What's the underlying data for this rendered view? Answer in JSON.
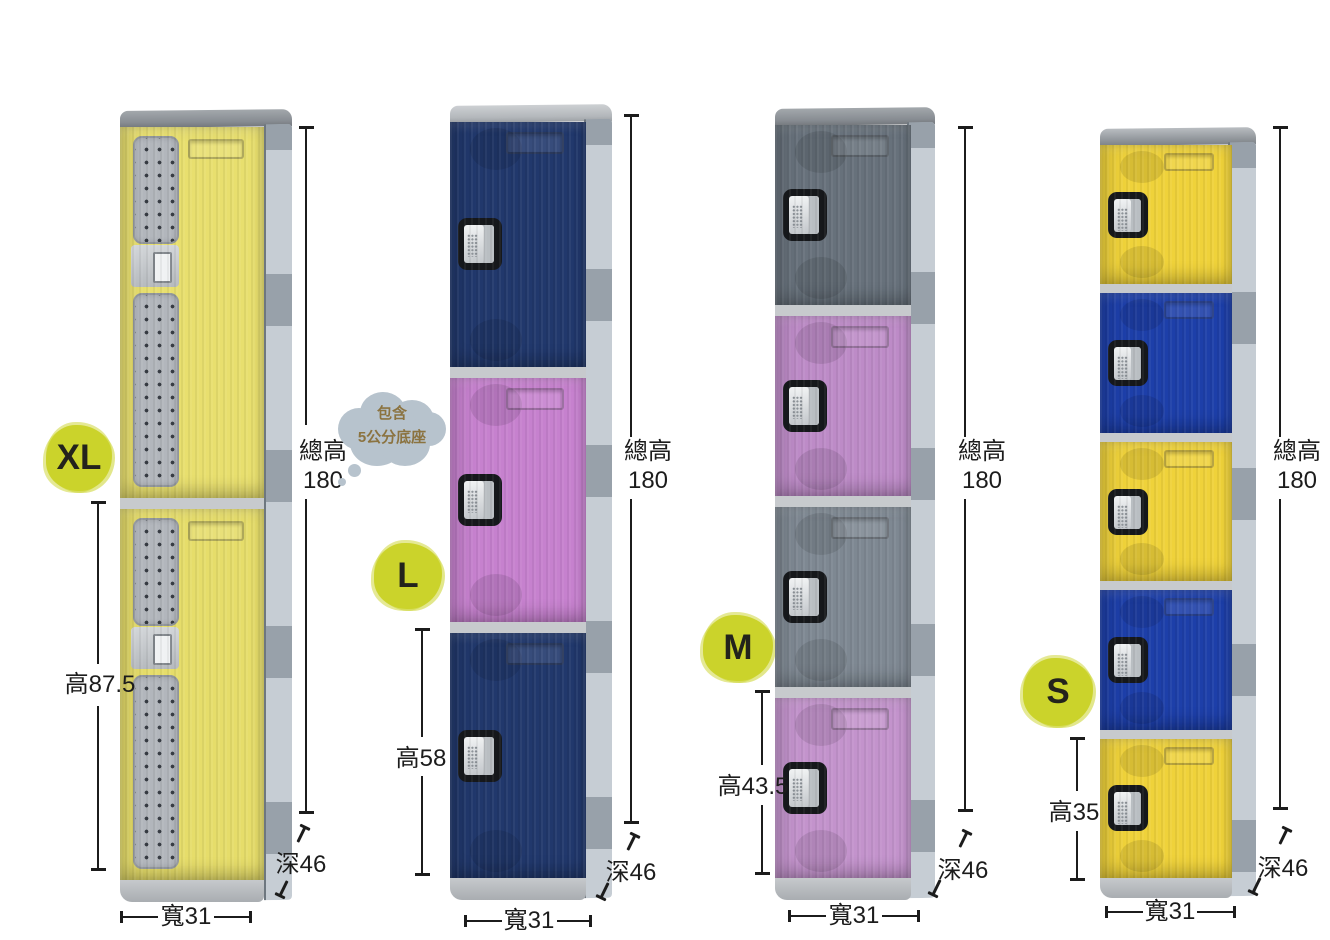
{
  "colors": {
    "badge_bg": "#cbd32b",
    "dimension": "#1c1c1c",
    "bubble_bg": "#b7c3cd",
    "bubble_text": "#8b7340"
  },
  "bubble": {
    "line1": "包含",
    "line2": "5公分底座"
  },
  "lockers": [
    {
      "size_label": "XL",
      "door_count": 2,
      "door_colors": [
        "#e8df6e",
        "#e6dd6a"
      ],
      "total_height_label": "總高",
      "total_height_value": "180",
      "compartment_height_label": "高87.5",
      "width_label": "寬31",
      "depth_label": "深46"
    },
    {
      "size_label": "L",
      "door_count": 3,
      "door_colors": [
        "#21386c",
        "#c681ce",
        "#21386c"
      ],
      "total_height_label": "總高",
      "total_height_value": "180",
      "compartment_height_label": "高58",
      "width_label": "寬31",
      "depth_label": "深46"
    },
    {
      "size_label": "M",
      "door_count": 4,
      "door_colors": [
        "#67717b",
        "#bd8bc7",
        "#7e8892",
        "#c393cc"
      ],
      "total_height_label": "總高",
      "total_height_value": "180",
      "compartment_height_label": "高43.5",
      "width_label": "寬31",
      "depth_label": "深46"
    },
    {
      "size_label": "S",
      "door_count": 5,
      "door_colors": [
        "#efd23a",
        "#1d3fa9",
        "#efd23a",
        "#1d3fa9",
        "#efd23a"
      ],
      "total_height_label": "總高",
      "total_height_value": "180",
      "compartment_height_label": "高35",
      "width_label": "寬31",
      "depth_label": "深46"
    }
  ]
}
